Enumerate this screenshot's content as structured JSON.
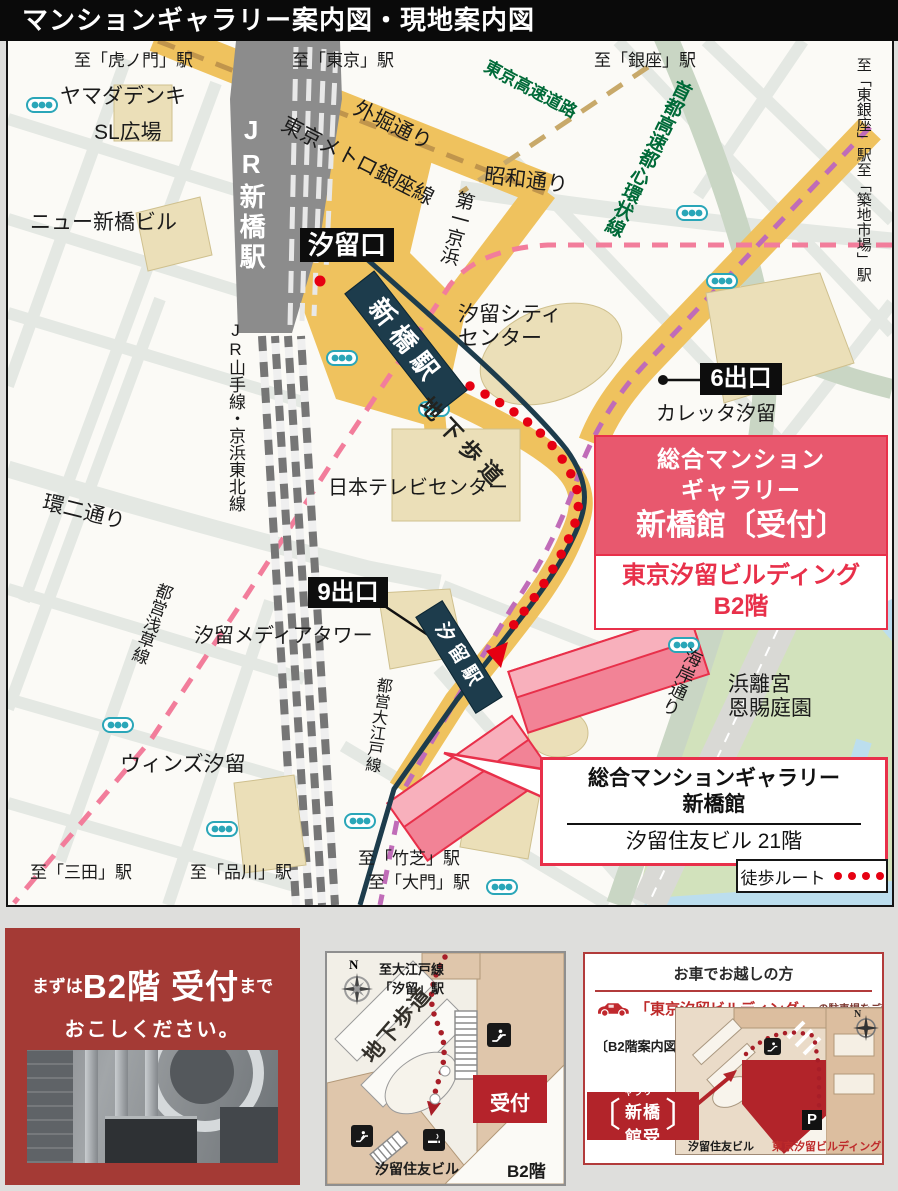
{
  "title": "マンションギャラリー案内図・現地案内図",
  "colors": {
    "callout_red": "#E8586E",
    "deep_red": "#B2242A",
    "panel_red": "#A43A35",
    "route_red": "#E60012",
    "yurikamome_navy": "#1D3C4C",
    "expressway_green_text": "#006A38",
    "road_yellow": "#EFC25E",
    "building_pink": "#F28396"
  },
  "map": {
    "labels": {
      "to_toranomon": "至「虎ノ門」駅",
      "yamada_denki": "ヤマダデンキ",
      "sl_plaza": "SL広場",
      "new_shimbashi_bldg": "ニュー新橋ビル",
      "to_tokyo": "至「東京」駅",
      "sotobori_dori": "外堀通り",
      "ginza_line": "東京メトロ銀座線",
      "showa_dori": "昭和通り",
      "tokyo_kosoku": "東京高速道路",
      "to_ginza": "至「銀座」駅",
      "shuto_kosoku": "首都高速都心環状線",
      "to_higashi_ginza": "至「東銀座」駅至「築地市場」駅",
      "daiichi_keihin": "第一京浜",
      "jr_shimbashi": "JR新橋駅",
      "jr_yamanote": "JR山手線・京浜東北線",
      "shiodome_exit": "汐留口",
      "yurikamome_shimbashi": "新橋駅",
      "shiodome_city_1": "汐留シティ",
      "shiodome_city_2": "センター",
      "exit6": "6出口",
      "caretta": "カレッタ汐留",
      "chika_hodo": "地下歩道",
      "nittele": "日本テレビセンター",
      "kanni_dori": "環二通り",
      "toei_asakusa": "都営浅草線",
      "exit9": "9出口",
      "media_tower": "汐留メディアタワー",
      "yurikamome_shiodome": "汐留駅",
      "toei_oedo": "都営大江戸線",
      "winz": "ウィンズ汐留",
      "to_mita": "至「三田」駅",
      "to_shinagawa": "至「品川」駅",
      "to_takeshiba": "至「竹芝」駅",
      "to_daimon": "至「大門」駅",
      "hamarikyu_1": "浜離宮",
      "hamarikyu_2": "恩賜庭園",
      "kaigan_dori": "海岸通り"
    },
    "compass_n": "N",
    "legend_walk_route": "徒歩ルート",
    "callout_reception": {
      "line1": "総合マンション",
      "line2": "ギャラリー",
      "line3": "新橋館〔受付〕",
      "sub1": "東京汐留ビルディング",
      "sub2": "B2階"
    },
    "callout_sumitomo": {
      "line1": "総合マンションギャラリー",
      "line2": "新橋館",
      "line3": "汐留住友ビル 21階"
    }
  },
  "panel_visit": {
    "prefix": "まずは",
    "highlight": "B2階 受付",
    "suffix": "まで",
    "line2": "おこしください。"
  },
  "panel_b2": {
    "compass_n": "N",
    "to_oedo_1": "至大江戸線",
    "to_oedo_2": "「汐留」駅",
    "chika_hodo": "地下歩道",
    "reception": "受付",
    "sumitomo": "汐留住友ビル",
    "floor": "B2階"
  },
  "panel_car": {
    "header": "お車でお越しの方",
    "bldg_bracket": "「東京汐留ビルディング」",
    "parking_note": "の駐車場をご利用ください。",
    "b2_map_label": "〔B2階案内図〕",
    "callout_line1": "総合マンションギャラリー",
    "callout_line2": "新橋館受付",
    "bracket_open": "〔",
    "bracket_close": "〕",
    "sumitomo": "汐留住友ビル",
    "shiodome_bldg": "東京汐留ビルディング",
    "parking_p": "P",
    "compass_n": "N"
  }
}
